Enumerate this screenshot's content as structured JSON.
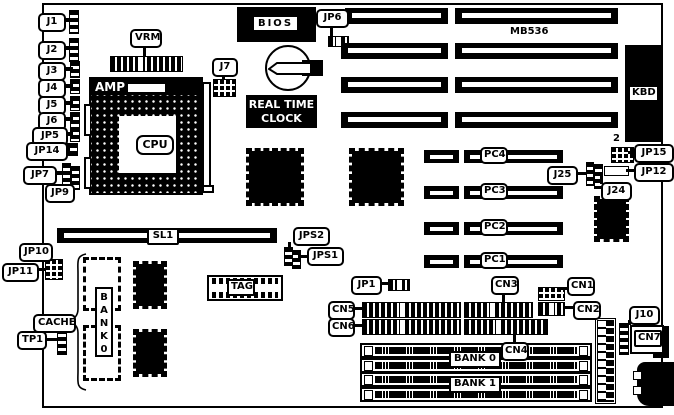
{
  "figure": {
    "type": "motherboard-diagram",
    "model": "MB536"
  },
  "labels": {
    "j1": "J1",
    "j2": "J2",
    "j3": "J3",
    "j4": "J4",
    "j5": "J5",
    "j6": "J6",
    "jp5": "JP5",
    "jp14": "JP14",
    "jp7": "JP7",
    "jp9": "JP9",
    "vrm": "VRM",
    "amp": "AMP",
    "cpu": "CPU",
    "j7": "J7",
    "bios": "BIOS",
    "jp6": "JP6",
    "model": "MB536",
    "kbd": "KBD",
    "two": "2",
    "jp15": "JP15",
    "jp12": "JP12",
    "j25": "J25",
    "j24": "J24",
    "pc4": "PC4",
    "pc3": "PC3",
    "pc2": "PC2",
    "pc1": "PC1",
    "sl1": "SL1",
    "jps2": "JPS2",
    "jps1": "JPS1",
    "tag": "TAG",
    "jp10": "JP10",
    "jp11": "JP11",
    "cache": "CACHE",
    "tp1": "TP1",
    "bank0_chip": "BANK0",
    "jp1": "JP1",
    "cn5": "CN5",
    "cn6": "CN6",
    "cn3": "CN3",
    "cn1": "CN1",
    "cn2": "CN2",
    "cn4": "CN4",
    "bank0": "BANK 0",
    "bank1": "BANK 1",
    "j10": "J10",
    "cn7": "CN7"
  },
  "rtc": {
    "line1": "REAL TIME",
    "line2": "CLOCK"
  }
}
